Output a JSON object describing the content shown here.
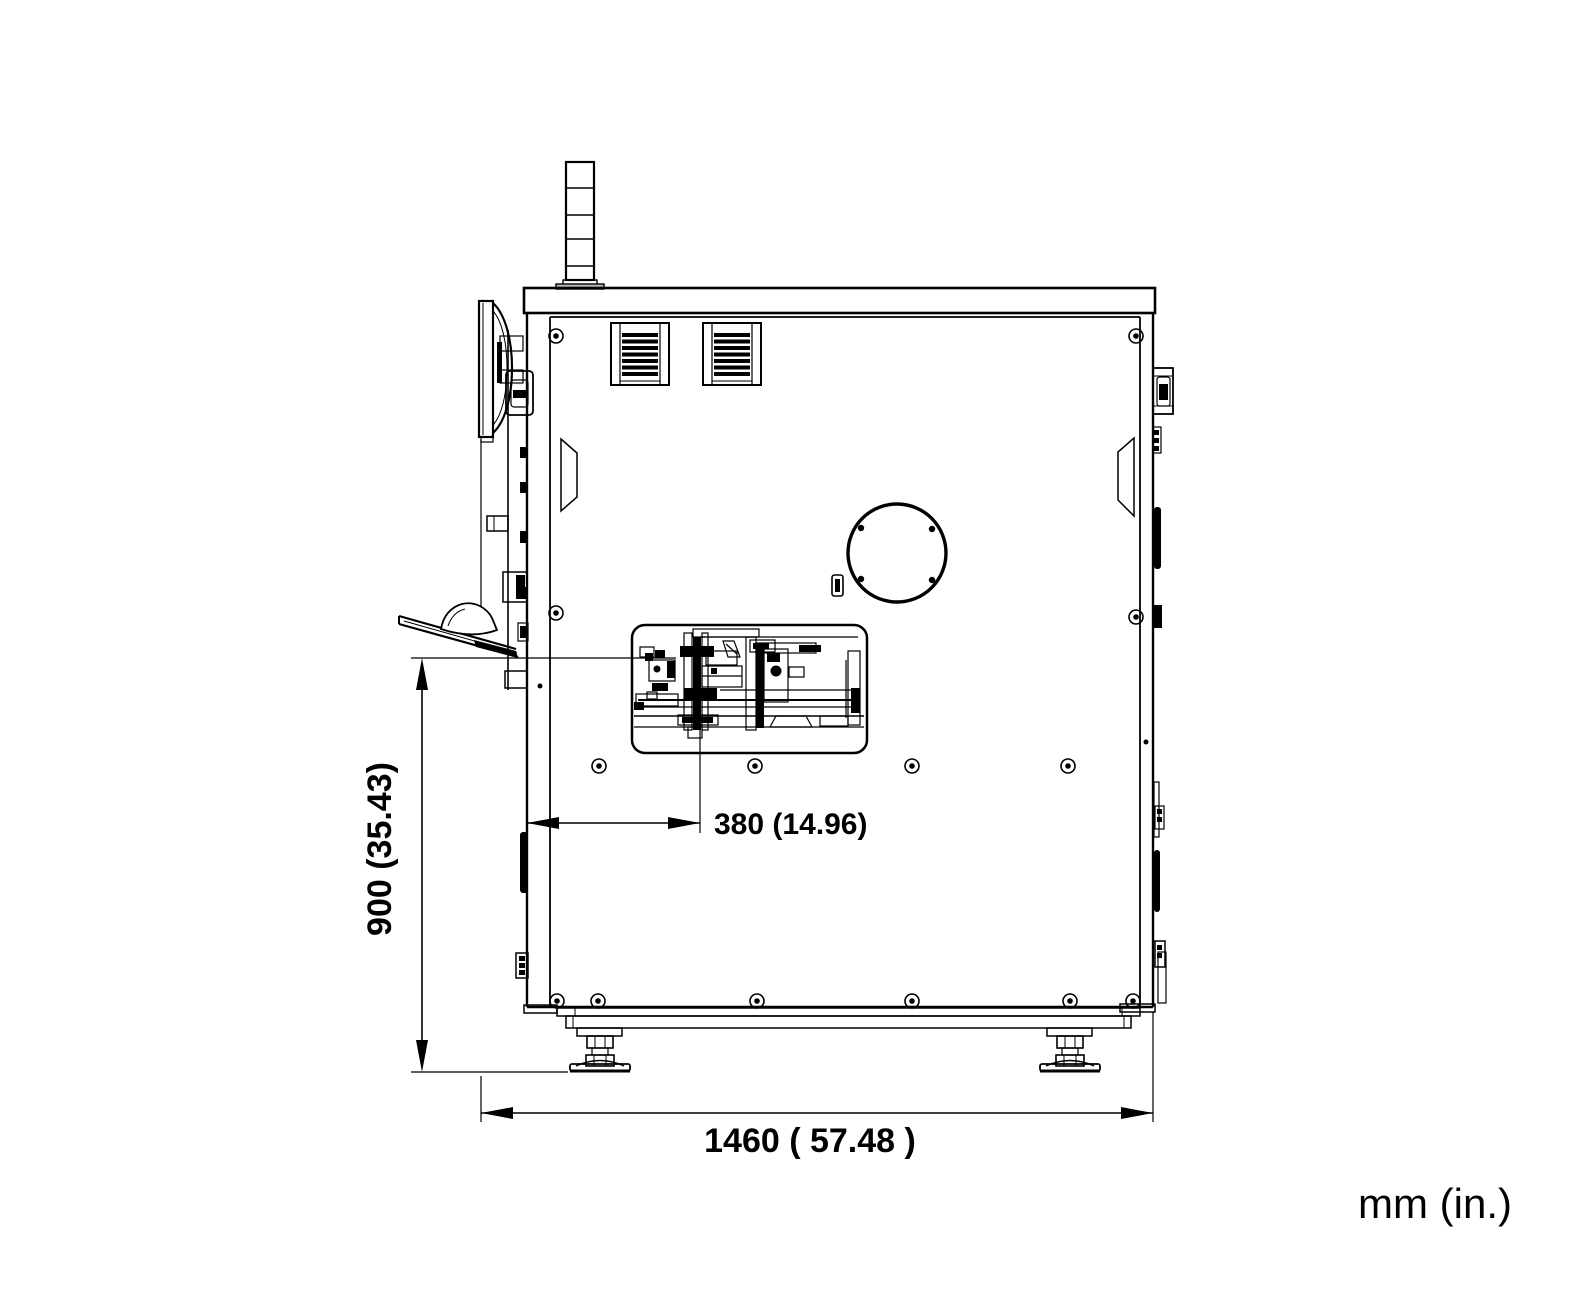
{
  "page": {
    "background": "#ffffff",
    "line_color": "#000000"
  },
  "drawing": {
    "view": "machine side elevation",
    "dimensions": {
      "height": {
        "label": "900 (35.43)"
      },
      "work_offset": {
        "label": "380 (14.96)"
      },
      "width": {
        "label": "1460 ( 57.48 )"
      }
    },
    "units_note": "mm (in.)"
  }
}
